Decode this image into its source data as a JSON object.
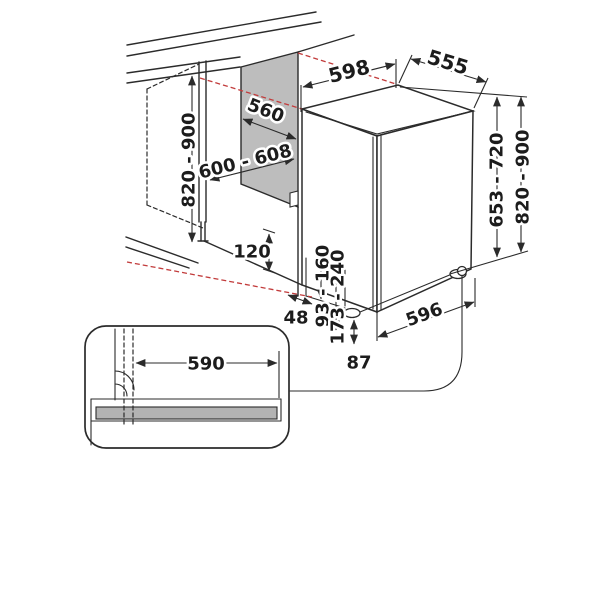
{
  "dimensions": {
    "niche_top_width": "598",
    "top_depth": "555",
    "panel_width": "560",
    "niche_width_range": "600 - 608",
    "niche_height_left": "820 - 900",
    "toe_recess_depth": "120",
    "side_gap": "48",
    "plinth_height_min_range": "93 - 160",
    "plinth_height_max_range": "173 - 240",
    "foot_height": "87",
    "base_depth": "596",
    "door_height_range": "653 - 720",
    "appliance_height_right": "820 - 900",
    "plinth_board_width": "590"
  },
  "colors": {
    "line": "#2b2b2b",
    "projection_red": "#c23b3b",
    "panel_gray": "#bdbdbd",
    "plinth_gray": "#b3b3b3"
  }
}
